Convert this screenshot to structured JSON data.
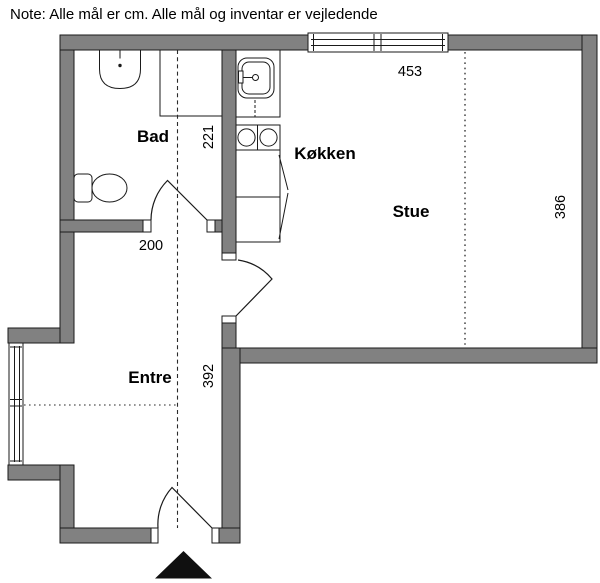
{
  "note": "Note: Alle mål er cm. Alle mål og inventar er vejledende",
  "rooms": [
    {
      "name": "Bad"
    },
    {
      "name": "Køkken"
    },
    {
      "name": "Stue"
    },
    {
      "name": "Entre"
    }
  ],
  "dimensions_cm": [
    {
      "value": "453"
    },
    {
      "value": "386"
    },
    {
      "value": "221"
    },
    {
      "value": "200"
    },
    {
      "value": "392"
    }
  ],
  "fixtures": [
    "washbasin-icon",
    "toilet-icon",
    "kitchen-sink-icon",
    "stove-icon",
    "entrance-arrow-icon",
    "window-icon",
    "door-swing-icon"
  ],
  "colors": {
    "wall": "#818181",
    "line": "#1a1a1a",
    "background": "#ffffff",
    "entrance_marker": "#101010"
  }
}
